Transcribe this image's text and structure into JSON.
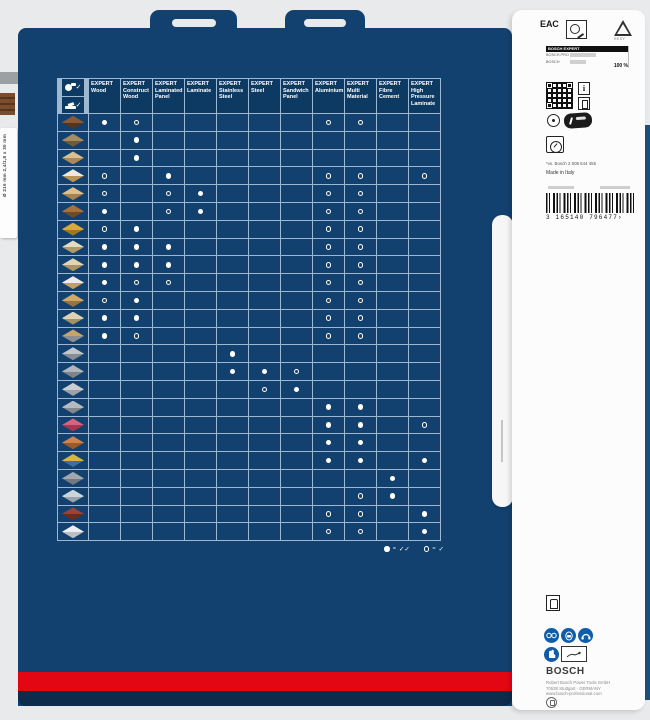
{
  "colors": {
    "card_blue": "#12416f",
    "header_blue": "#0d3a63",
    "grid_line": "#9db8d0",
    "red_stripe": "#e30613",
    "bottom_band": "#0d2b4b",
    "safety_blue": "#0f5ca8"
  },
  "left_edge": {
    "spine_label": "Ø 216 mm  2,4/1,8 x 30 mm"
  },
  "matrix": {
    "tool_legend": [
      {
        "icon": "circular-saw-icon",
        "check": "✓"
      },
      {
        "icon": "mitre-saw-icon",
        "check": "✓"
      }
    ],
    "columns": [
      {
        "brand": "EXPERT",
        "name": "Wood"
      },
      {
        "brand": "EXPERT",
        "name": "Construct Wood"
      },
      {
        "brand": "EXPERT",
        "name": "Laminated Panel"
      },
      {
        "brand": "EXPERT",
        "name": "Laminate"
      },
      {
        "brand": "EXPERT",
        "name": "Stainless Steel"
      },
      {
        "brand": "EXPERT",
        "name": "Steel"
      },
      {
        "brand": "EXPERT",
        "name": "Sandwich Panel"
      },
      {
        "brand": "EXPERT",
        "name": "Aluminium"
      },
      {
        "brand": "EXPERT",
        "name": "Multi Material"
      },
      {
        "brand": "EXPERT",
        "name": "Fibre Cement"
      },
      {
        "brand": "EXPERT",
        "name": "High Pressure Laminate"
      }
    ],
    "rows": [
      {
        "icon": "hardwood-planks-icon",
        "top": "#8a5a33",
        "side": "#55351c",
        "dots": {
          "1": "filled",
          "2": "open",
          "8": "open",
          "9": "open"
        }
      },
      {
        "icon": "construct-wood-nails-icon",
        "top": "#a58d62",
        "side": "#6e5a3a",
        "dots": {
          "2": "filled"
        }
      },
      {
        "icon": "softwood-beam-icon",
        "top": "#d9c090",
        "side": "#a8895c",
        "dots": {
          "2": "filled"
        }
      },
      {
        "icon": "coated-panel-icon",
        "top": "#eee9dc",
        "side": "#b99455",
        "dots": {
          "1": "open",
          "3": "filled",
          "8": "open",
          "9": "open",
          "11": "open"
        }
      },
      {
        "icon": "laminate-flooring-icon",
        "top": "#dcc18c",
        "side": "#a8824e",
        "dots": {
          "1": "open",
          "3": "open",
          "4": "filled",
          "8": "open",
          "9": "open"
        }
      },
      {
        "icon": "solid-wood-board-icon",
        "top": "#a4713f",
        "side": "#6f4a26",
        "dots": {
          "1": "filled",
          "3": "open",
          "4": "filled",
          "8": "open",
          "9": "open"
        }
      },
      {
        "icon": "osb-board-icon",
        "top": "#d9a93c",
        "side": "#a07722",
        "dots": {
          "1": "open",
          "2": "filled",
          "8": "open",
          "9": "open"
        }
      },
      {
        "icon": "plywood-panel-icon",
        "top": "#e6dbc0",
        "side": "#b09a6a",
        "dots": {
          "1": "filled",
          "2": "filled",
          "3": "filled",
          "8": "open",
          "9": "open"
        }
      },
      {
        "icon": "birch-plywood-icon",
        "top": "#e2d5b6",
        "side": "#ab9464",
        "dots": {
          "1": "filled",
          "2": "filled",
          "3": "filled",
          "8": "open",
          "9": "open"
        }
      },
      {
        "icon": "melamine-panel-icon",
        "top": "#ecebe6",
        "side": "#c2a061",
        "dots": {
          "1": "filled",
          "2": "open",
          "3": "open",
          "8": "open",
          "9": "open"
        }
      },
      {
        "icon": "chipboard-icon",
        "top": "#cfa96a",
        "side": "#97743f",
        "dots": {
          "1": "open",
          "2": "filled",
          "8": "open",
          "9": "open"
        }
      },
      {
        "icon": "glued-wood-planks-icon",
        "top": "#ddd2b4",
        "side": "#a39266",
        "dots": {
          "1": "filled",
          "2": "filled",
          "8": "open",
          "9": "open"
        }
      },
      {
        "icon": "wood-with-metal-icon",
        "top": "#c9a469",
        "side": "#8b8f94",
        "dots": {
          "1": "filled",
          "2": "open",
          "8": "open",
          "9": "open"
        }
      },
      {
        "icon": "stainless-steel-sheet-icon",
        "top": "#c2c7cc",
        "side": "#878d93",
        "dots": {
          "5": "filled"
        }
      },
      {
        "icon": "corrugated-steel-icon",
        "top": "#b0b6bc",
        "side": "#7d848b",
        "dots": {
          "5": "filled",
          "6": "filled",
          "7": "open"
        }
      },
      {
        "icon": "sandwich-panel-icon",
        "top": "#c8cdd2",
        "side": "#9aa1a8",
        "dots": {
          "6": "open",
          "7": "filled"
        }
      },
      {
        "icon": "aluminium-profiles-icon",
        "top": "#b4bac0",
        "side": "#82898f",
        "dots": {
          "8": "filled",
          "9": "filled"
        }
      },
      {
        "icon": "acrylic-sheet-icon",
        "top": "#d9627f",
        "side": "#a33852",
        "dots": {
          "8": "filled",
          "9": "filled",
          "11": "open"
        }
      },
      {
        "icon": "multilayer-panel-icon",
        "top": "#d08449",
        "side": "#9b5a2a",
        "dots": {
          "8": "filled",
          "9": "filled"
        }
      },
      {
        "icon": "flooring-multilayer-icon",
        "top": "#ddb33f",
        "side": "#3f6f9f",
        "dots": {
          "8": "filled",
          "9": "filled",
          "11": "filled"
        }
      },
      {
        "icon": "fibre-cement-board-icon",
        "top": "#a2a7ac",
        "side": "#74797e",
        "dots": {
          "10": "filled"
        }
      },
      {
        "icon": "plasterboard-icon",
        "top": "#ccd5da",
        "side": "#98a3aa",
        "dots": {
          "9": "open",
          "10": "filled"
        }
      },
      {
        "icon": "hpl-board-icon",
        "top": "#9b4436",
        "side": "#6b2b20",
        "dots": {
          "8": "open",
          "9": "open",
          "11": "filled"
        }
      },
      {
        "icon": "mineral-material-icon",
        "top": "#eceef0",
        "side": "#b9bfc4",
        "dots": {
          "8": "open",
          "9": "open",
          "11": "filled"
        }
      }
    ],
    "legend": {
      "equals": "=",
      "filled_meaning": "✓✓",
      "open_meaning": "✓"
    }
  },
  "side_panel": {
    "eac_label": "ЕАС",
    "resy_label": "RESY",
    "compare": {
      "top_label": "BOSCH EXPERT",
      "mid_label": "BOSCH PRO",
      "low_label": "BOSCH",
      "value": "100 %"
    },
    "info_icon_label": "i",
    "footnote": "*vs. Bosch 2 608 644 455",
    "origin": "Made in Italy",
    "barcode_digits": "3 165140 796477",
    "barcode_guard": "›",
    "bosch_logo": "BOSCH",
    "address": [
      "Robert Bosch Power Tools GmbH",
      "70538 Stuttgart · GERMANY",
      "www.bosch-professional.com"
    ]
  }
}
